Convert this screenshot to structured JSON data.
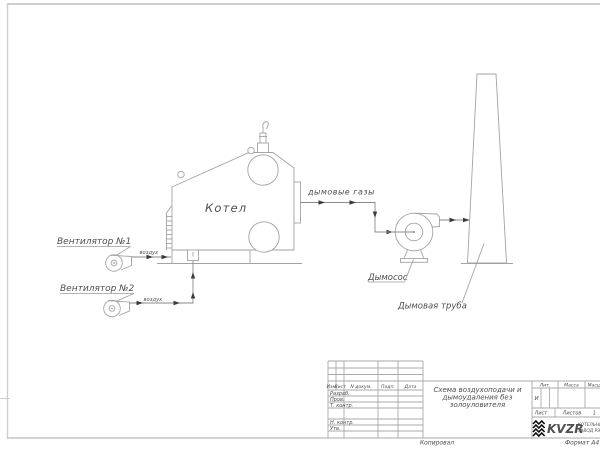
{
  "drawing": {
    "labels": {
      "boiler": "Котел",
      "fan1": "Вентилятор №1",
      "fan2": "Вентилятор №2",
      "air1": "воздух",
      "air2": "воздух",
      "flue_gases": "дымовые газы",
      "smoke_exhauster": "Дымосос",
      "chimney": "Дымовая труба"
    }
  },
  "title_block": {
    "doc_title_lines": [
      "Схема воздухоподачи и",
      "дымоудаления без",
      "золоуловителя"
    ],
    "columns": {
      "izm": "Изм.",
      "list": "Лист",
      "doc_num": "N докум.",
      "sign": "Подп.",
      "date": "Дата"
    },
    "rows": {
      "developed": "Разраб.",
      "checked": "Пров.",
      "t_control": "Т. контр.",
      "n_control": "Н. контр.",
      "approved": "Утв."
    },
    "lit_header": "Лит.",
    "lit_value": "И",
    "mass_header": "Масса",
    "scale_header": "Масштаб",
    "sheet_label": "Лист",
    "sheets_label": "Листов",
    "sheets_value": "1",
    "company": {
      "logo_text": "KVZR",
      "name_line1": "КОТЕЛЬНЫЙ",
      "name_line2": "ЗАВОД РЭ"
    }
  },
  "footer": {
    "copied_label": "Копировал",
    "format_label": "Формат А4"
  },
  "colors": {
    "paper": "#ffffff",
    "drawing_line": "#a3a3a3",
    "flow_line": "#8a8a8a",
    "arrow": "#3c3c3c",
    "text": "#4f4f4f",
    "grid_line": "#a9a9a9",
    "frame_line": "#cfcfcf",
    "logo_black": "#0a0a0a"
  }
}
